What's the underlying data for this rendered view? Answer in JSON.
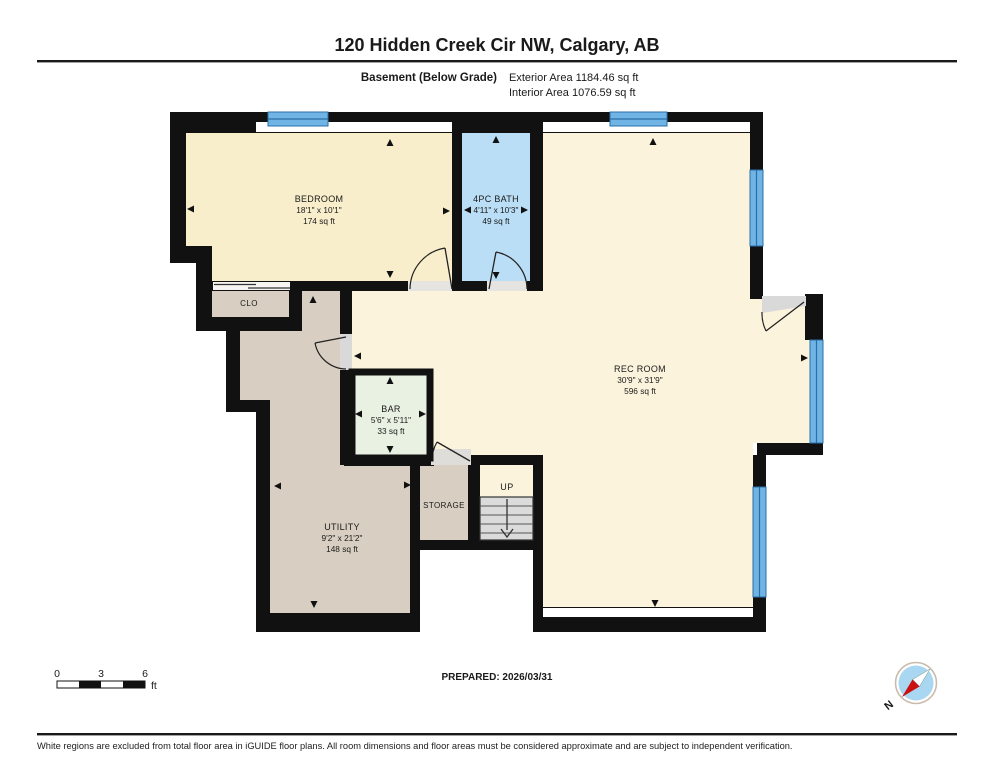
{
  "header": {
    "title": "120 Hidden Creek Cir NW, Calgary, AB",
    "floor_label": "Basement (Below Grade)",
    "exterior_area": "Exterior Area 1184.46 sq ft",
    "interior_area": "Interior Area 1076.59 sq ft"
  },
  "rooms": {
    "bedroom": {
      "name": "BEDROOM",
      "dims": "18'1\" x 10'1\"",
      "area": "174 sq ft"
    },
    "bath": {
      "name": "4PC BATH",
      "dims": "4'11\" x 10'3\"",
      "area": "49 sq ft"
    },
    "rec": {
      "name": "REC ROOM",
      "dims": "30'9\" x 31'9\"",
      "area": "596 sq ft"
    },
    "bar": {
      "name": "BAR",
      "dims": "5'6\" x 5'11\"",
      "area": "33 sq ft"
    },
    "utility": {
      "name": "UTILITY",
      "dims": "9'2\" x 21'2\"",
      "area": "148 sq ft"
    },
    "closet": {
      "name": "CLO"
    },
    "storage": {
      "name": "STORAGE"
    },
    "stairs": {
      "label": "UP"
    }
  },
  "footer": {
    "scale": {
      "tick0": "0",
      "tick3": "3",
      "tick6": "6",
      "unit": "ft"
    },
    "prepared": "PREPARED: 2026/03/31",
    "compass_n": "N",
    "disclaimer": "White regions are excluded from total floor area in iGUIDE floor plans. All room dimensions and floor areas must be considered approximate and are subject to independent verification."
  },
  "colors": {
    "wall": "#111111",
    "room_cream": "#F9EECB",
    "living_cream": "#FCF3DC",
    "bath_blue": "#BADEF5",
    "window_blue": "#6FB4E4",
    "window_line": "#2B6FA8",
    "hall_tan": "#D8CFC2",
    "bar_green": "#E9F1E3",
    "stair_gray": "#DBDBDB",
    "sill_gray": "#D9D9D9",
    "compass_red": "#CC1111",
    "compass_blue": "#A9D6F0"
  }
}
